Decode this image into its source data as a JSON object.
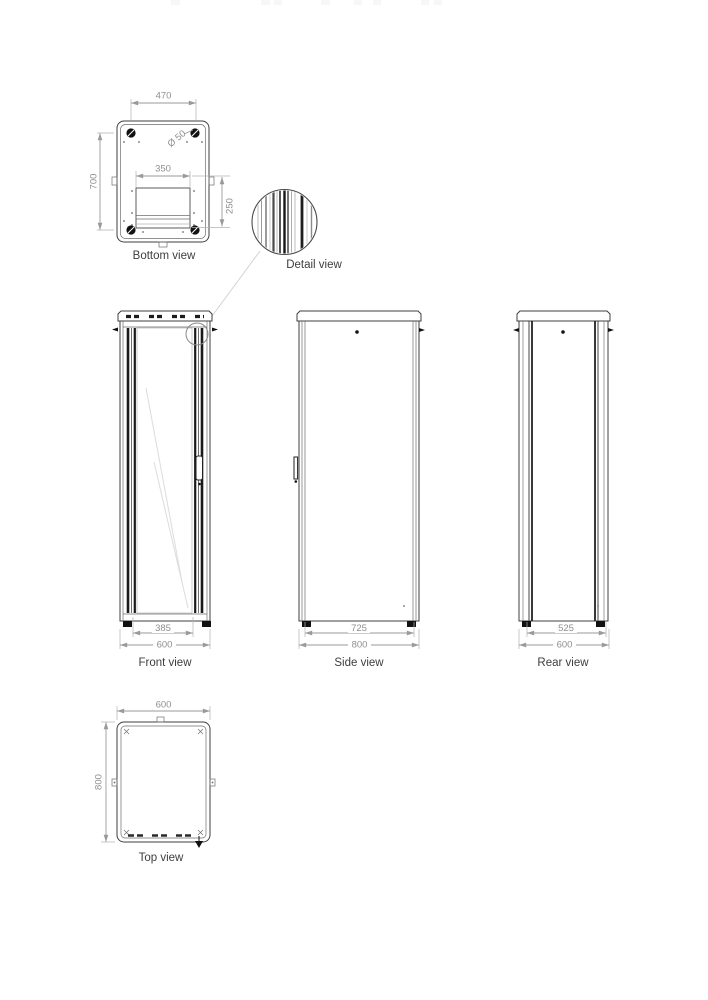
{
  "drawing_type": "cabinet-technical-drawing",
  "views": {
    "bottom": {
      "label": "Bottom view",
      "dim_width": "470",
      "dim_depth": "700",
      "dim_cutout_width": "350",
      "dim_cutout_depth": "250",
      "dim_caster": "Ø 50"
    },
    "detail": {
      "label": "Detail view"
    },
    "front": {
      "label": "Front view",
      "dim_inner": "385",
      "dim_outer": "600"
    },
    "side": {
      "label": "Side view",
      "dim_feet": "725",
      "dim_outer": "800"
    },
    "rear": {
      "label": "Rear view",
      "dim_feet": "525",
      "dim_outer": "600"
    },
    "top": {
      "label": "Top view",
      "dim_width": "600",
      "dim_depth": "800"
    }
  },
  "colors": {
    "background": "#ffffff",
    "part_line": "#3f3f3f",
    "dimension": "#9a9a9a",
    "dark_fill": "#111111",
    "label_text": "#3d3d3d"
  }
}
